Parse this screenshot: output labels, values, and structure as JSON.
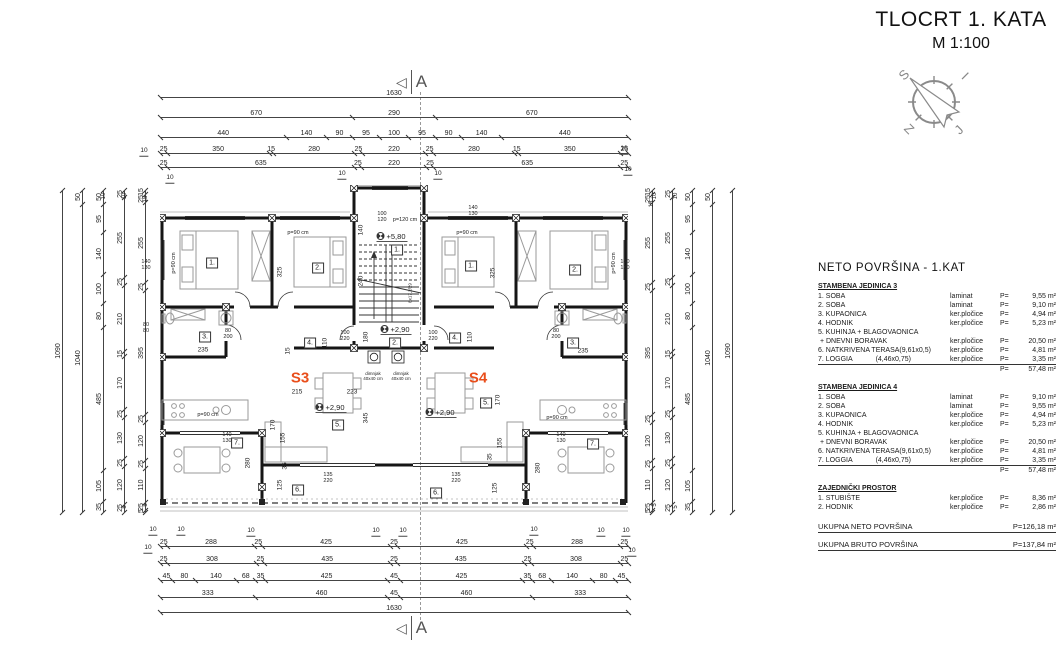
{
  "title": {
    "line1": "TLOCRT 1. KATA",
    "line2": "M 1:100"
  },
  "colors": {
    "accent": "#e94e1b",
    "ink": "#1a1a1a"
  },
  "compass": {
    "nw": "S",
    "ne": "I",
    "sw": "Z",
    "se": "J"
  },
  "section_marker": "A",
  "area_table": {
    "heading": "NETO  POVRŠINA - 1.KAT",
    "sections": [
      {
        "title": "STAMBENA JEDINICA 3",
        "rows": [
          [
            "1. SOBA",
            "laminat",
            "9,55 m²"
          ],
          [
            "2. SOBA",
            "laminat",
            "9,10 m²"
          ],
          [
            "3. KUPAONICA",
            "ker.pločice",
            "4,94 m²"
          ],
          [
            "4. HODNIK",
            "ker.pločice",
            "5,23 m²"
          ],
          [
            "5. KUHINJA + BLAGOVAONICA",
            "",
            ""
          ],
          [
            " + DNEVNI BORAVAK",
            "ker.pločice",
            "20,50 m²"
          ],
          [
            "6. NATKRIVENA TERASA(9,61x0,5)",
            "ker.pločice",
            "4,81 m²"
          ],
          [
            "7. LOGGIA            (4,46x0,75)",
            "ker.pločice",
            "3,35 m²",
            true
          ]
        ],
        "sum": "57,48 m²"
      },
      {
        "title": "STAMBENA JEDINICA 4",
        "rows": [
          [
            "1. SOBA",
            "laminat",
            "9,10 m²"
          ],
          [
            "2. SOBA",
            "laminat",
            "9,55 m²"
          ],
          [
            "3. KUPAONICA",
            "ker.pločice",
            "4,94 m²"
          ],
          [
            "4. HODNIK",
            "ker.pločice",
            "5,23 m²"
          ],
          [
            "5. KUHINJA + BLAGOVAONICA",
            "",
            ""
          ],
          [
            " + DNEVNI BORAVAK",
            "ker.pločice",
            "20,50 m²"
          ],
          [
            "6. NATKRIVENA TERASA(9,61x0,5)",
            "ker.pločice",
            "4,81 m²"
          ],
          [
            "7. LOGGIA            (4,46x0,75)",
            "ker.pločice",
            "3,35 m²",
            true
          ]
        ],
        "sum": "57,48 m²"
      },
      {
        "title": "ZAJEDNIČKI PROSTOR",
        "rows": [
          [
            "1. STUBIŠTE",
            "ker.pločice",
            "8,36 m²"
          ],
          [
            "2. HODNIK",
            "ker.pločice",
            "2,86 m²"
          ]
        ],
        "sum": null
      }
    ],
    "p_label": "P=",
    "totals": [
      [
        "UKUPNA NETO POVRŠINA",
        "P=126,18 m²"
      ],
      [
        "UKUPNA BRUTO POVRŠINA",
        "P=137,84 m²"
      ]
    ]
  },
  "dims": {
    "top": [
      [
        "1630"
      ],
      [
        "670",
        "290",
        "670"
      ],
      [
        "440",
        "140",
        "90",
        "95",
        "100",
        "95",
        "90",
        "140",
        "440"
      ],
      [
        "25",
        "350",
        "15",
        "280",
        "25",
        "220",
        "25",
        "280",
        "15",
        "350",
        "25"
      ],
      [
        "25",
        "635",
        "25",
        "220",
        "25",
        "635",
        "25"
      ]
    ],
    "bottom": [
      [
        "25",
        "288",
        "25",
        "425",
        "25",
        "425",
        "25",
        "288",
        "25"
      ],
      [
        "25",
        "308",
        "25",
        "435",
        "25",
        "435",
        "25",
        "308",
        "25"
      ],
      [
        "45",
        "80",
        "140",
        "68",
        "35",
        "425",
        "45",
        "425",
        "35",
        "68",
        "140",
        "80",
        "45"
      ],
      [
        "333",
        "460",
        "45",
        "460",
        "333"
      ],
      [
        "1630"
      ]
    ],
    "side": [
      [
        "1090"
      ],
      [
        "50",
        "1040"
      ],
      [
        "50",
        "95",
        "140",
        "100",
        "80",
        "485",
        "105",
        "35"
      ],
      [
        "25",
        "255",
        "25",
        "210",
        "15",
        "170",
        "25",
        "130",
        "25",
        "120",
        "25"
      ],
      [
        "15",
        "25",
        "255",
        "25",
        "395",
        "25",
        "120",
        "25",
        "110",
        "25",
        "5"
      ]
    ]
  },
  "plan": {
    "annotations": [
      {
        "t": "S3",
        "x": 140,
        "y": 193,
        "c": "unit"
      },
      {
        "t": "S4",
        "x": 318,
        "y": 193,
        "c": "unit"
      },
      {
        "t": "1.",
        "x": 52,
        "y": 78,
        "c": "room"
      },
      {
        "t": "2.",
        "x": 158,
        "y": 83,
        "c": "room"
      },
      {
        "t": "3.",
        "x": 45,
        "y": 152,
        "c": "room"
      },
      {
        "t": "4.",
        "x": 150,
        "y": 158,
        "c": "room"
      },
      {
        "t": "5.",
        "x": 178,
        "y": 240,
        "c": "room"
      },
      {
        "t": "7.",
        "x": 77,
        "y": 258,
        "c": "room"
      },
      {
        "t": "6.",
        "x": 138,
        "y": 305,
        "c": "room"
      },
      {
        "t": "1.",
        "x": 237,
        "y": 65,
        "c": "room"
      },
      {
        "t": "2.",
        "x": 235,
        "y": 158,
        "c": "room"
      },
      {
        "t": "1.",
        "x": 311,
        "y": 81,
        "c": "room"
      },
      {
        "t": "2.",
        "x": 415,
        "y": 85,
        "c": "room"
      },
      {
        "t": "3.",
        "x": 413,
        "y": 158,
        "c": "room"
      },
      {
        "t": "4.",
        "x": 295,
        "y": 153,
        "c": "room"
      },
      {
        "t": "5.",
        "x": 326,
        "y": 218,
        "c": "room"
      },
      {
        "t": "7.",
        "x": 433,
        "y": 259,
        "c": "room"
      },
      {
        "t": "6.",
        "x": 276,
        "y": 308,
        "c": "room"
      },
      {
        "t": "+5,80",
        "x": 232,
        "y": 52,
        "c": "lvl"
      },
      {
        "t": "+2,90",
        "x": 236,
        "y": 145,
        "c": "lvl"
      },
      {
        "t": "+2,90",
        "x": 171,
        "y": 223,
        "c": "lvl"
      },
      {
        "t": "+2,90",
        "x": 281,
        "y": 228,
        "c": "lvl"
      },
      {
        "t": "p=120 cm",
        "x": 245,
        "y": 35,
        "c": "note"
      },
      {
        "t": "p=90 cm",
        "x": 138,
        "y": 48,
        "c": "note"
      },
      {
        "t": "p=90 cm",
        "x": 307,
        "y": 48,
        "c": "note"
      },
      {
        "t": "p=90 cm",
        "x": 48,
        "y": 230,
        "c": "note"
      },
      {
        "t": "p=90 cm",
        "x": 397,
        "y": 233,
        "c": "note"
      },
      {
        "t": "p=90 cm",
        "x": 14,
        "y": 78,
        "c": "notev"
      },
      {
        "t": "p=90 cm",
        "x": 454,
        "y": 78,
        "c": "notev"
      },
      {
        "t": "dimnjak\n40x40 cm",
        "x": 213,
        "y": 191,
        "c": "tiny"
      },
      {
        "t": "dimnjak\n40x40 cm",
        "x": 241,
        "y": 191,
        "c": "tiny"
      },
      {
        "t": "325",
        "x": 120,
        "y": 87,
        "c": "dimv"
      },
      {
        "t": "325",
        "x": 333,
        "y": 88,
        "c": "dimv"
      },
      {
        "t": "140",
        "x": 201,
        "y": 45,
        "c": "dimv"
      },
      {
        "t": "240",
        "x": 201,
        "y": 96,
        "c": "dimv"
      },
      {
        "t": "180",
        "x": 206,
        "y": 152,
        "c": "dimv"
      },
      {
        "t": "345",
        "x": 206,
        "y": 233,
        "c": "dimv"
      },
      {
        "t": "170",
        "x": 113,
        "y": 240,
        "c": "dimv"
      },
      {
        "t": "170",
        "x": 338,
        "y": 215,
        "c": "dimv"
      },
      {
        "t": "110",
        "x": 165,
        "y": 158,
        "c": "dimv"
      },
      {
        "t": "110",
        "x": 310,
        "y": 152,
        "c": "dimv"
      },
      {
        "t": "155",
        "x": 123,
        "y": 253,
        "c": "dimv"
      },
      {
        "t": "155",
        "x": 340,
        "y": 258,
        "c": "dimv"
      },
      {
        "t": "280",
        "x": 88,
        "y": 278,
        "c": "dimv"
      },
      {
        "t": "280",
        "x": 378,
        "y": 283,
        "c": "dimv"
      },
      {
        "t": "125",
        "x": 120,
        "y": 300,
        "c": "dimv"
      },
      {
        "t": "125",
        "x": 335,
        "y": 303,
        "c": "dimv"
      },
      {
        "t": "35",
        "x": 125,
        "y": 281,
        "c": "dimv"
      },
      {
        "t": "35",
        "x": 330,
        "y": 272,
        "c": "dimv"
      },
      {
        "t": "15",
        "x": 128,
        "y": 166,
        "c": "dimv"
      },
      {
        "t": "8x17,2/29",
        "x": 250,
        "y": 108,
        "c": "dimv tiny"
      },
      {
        "t": "235",
        "x": 43,
        "y": 165,
        "c": "dim"
      },
      {
        "t": "235",
        "x": 423,
        "y": 166,
        "c": "dim"
      },
      {
        "t": "215",
        "x": 137,
        "y": 207,
        "c": "dim"
      },
      {
        "t": "223",
        "x": 192,
        "y": 207,
        "c": "dim"
      },
      {
        "t": "80\n200",
        "x": 68,
        "y": 149,
        "c": "dims"
      },
      {
        "t": "80\n200",
        "x": 396,
        "y": 149,
        "c": "dims"
      },
      {
        "t": "100\n220",
        "x": 185,
        "y": 151,
        "c": "dims"
      },
      {
        "t": "100\n220",
        "x": 273,
        "y": 151,
        "c": "dims"
      },
      {
        "t": "140\n130",
        "x": -14,
        "y": 80,
        "c": "dims"
      },
      {
        "t": "140\n130",
        "x": 465,
        "y": 80,
        "c": "dims"
      },
      {
        "t": "140\n130",
        "x": 313,
        "y": 26,
        "c": "dims"
      },
      {
        "t": "140\n130",
        "x": 67,
        "y": 253,
        "c": "dims"
      },
      {
        "t": "140\n130",
        "x": 401,
        "y": 253,
        "c": "dims"
      },
      {
        "t": "80\n80",
        "x": -14,
        "y": 143,
        "c": "dims"
      },
      {
        "t": "100\n120",
        "x": 222,
        "y": 32,
        "c": "dims"
      },
      {
        "t": "135\n220",
        "x": 168,
        "y": 293,
        "c": "dims"
      },
      {
        "t": "135\n220",
        "x": 296,
        "y": 293,
        "c": "dims"
      }
    ]
  },
  "page_labels": [
    {
      "t": "10",
      "x": 144,
      "y": 152
    },
    {
      "t": "10",
      "x": 624,
      "y": 150
    },
    {
      "t": "10",
      "x": 170,
      "y": 179
    },
    {
      "t": "10",
      "x": 342,
      "y": 175
    },
    {
      "t": "10",
      "x": 438,
      "y": 175
    },
    {
      "t": "10",
      "x": 628,
      "y": 171
    },
    {
      "t": "10",
      "x": 153,
      "y": 531
    },
    {
      "t": "10",
      "x": 181,
      "y": 531
    },
    {
      "t": "10",
      "x": 251,
      "y": 532
    },
    {
      "t": "10",
      "x": 376,
      "y": 532
    },
    {
      "t": "10",
      "x": 403,
      "y": 532
    },
    {
      "t": "10",
      "x": 534,
      "y": 531
    },
    {
      "t": "10",
      "x": 601,
      "y": 532
    },
    {
      "t": "10",
      "x": 626,
      "y": 532
    },
    {
      "t": "10",
      "x": 148,
      "y": 549
    },
    {
      "t": "10",
      "x": 632,
      "y": 552
    },
    {
      "t": "10",
      "x": 104,
      "y": 196,
      "v": 1
    },
    {
      "t": "10",
      "x": 125,
      "y": 196,
      "v": 1
    },
    {
      "t": "15",
      "x": 146,
      "y": 199,
      "v": 1
    },
    {
      "t": "10",
      "x": 676,
      "y": 196,
      "v": 1
    },
    {
      "t": "10",
      "x": 655,
      "y": 196,
      "v": 1
    },
    {
      "t": "15",
      "x": 652,
      "y": 204,
      "v": 1
    },
    {
      "t": "5",
      "x": 125,
      "y": 507,
      "v": 1
    },
    {
      "t": "5",
      "x": 146,
      "y": 505,
      "v": 1
    },
    {
      "t": "5",
      "x": 655,
      "y": 505,
      "v": 1
    },
    {
      "t": "5",
      "x": 676,
      "y": 507,
      "v": 1
    }
  ]
}
